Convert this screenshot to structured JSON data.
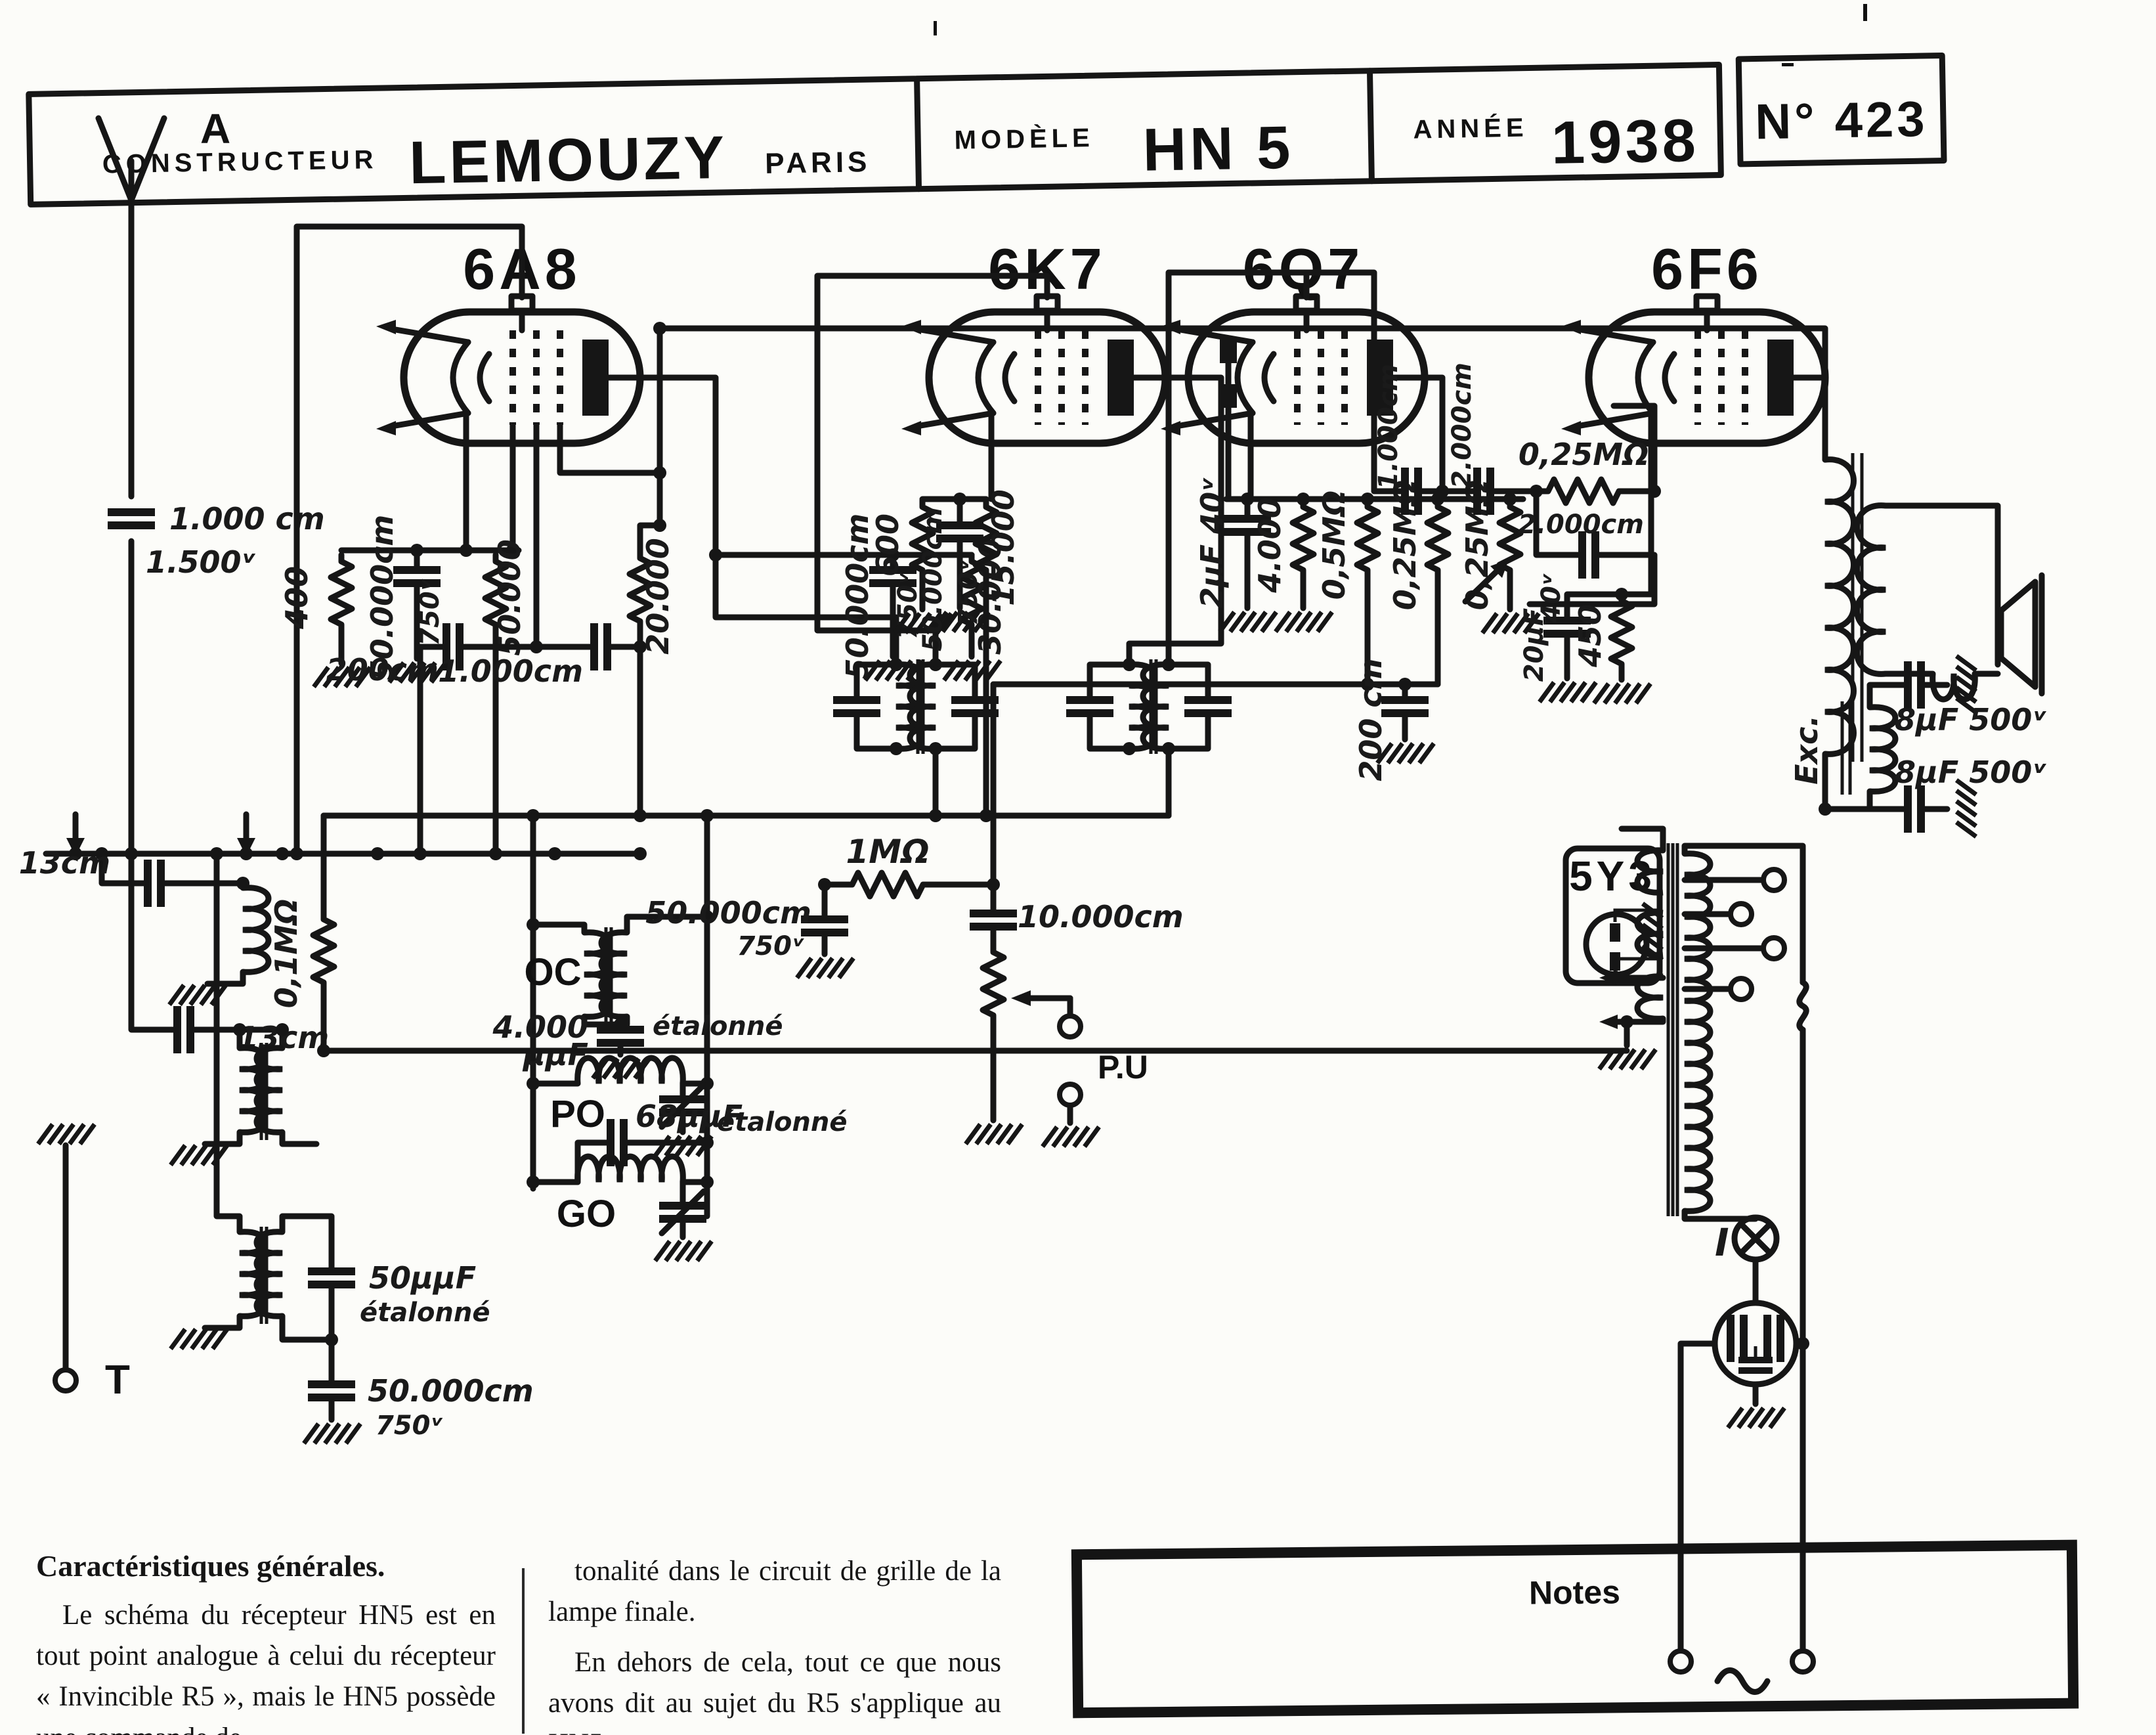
{
  "header": {
    "constructeur_label": "CONSTRUCTEUR",
    "brand": "LEMOUZY",
    "city": "PARIS",
    "modele_label": "MODÈLE",
    "modele_value": "HN 5",
    "annee_label": "ANNÉE",
    "annee_value": "1938",
    "numero": "N° 423"
  },
  "tubes": {
    "t1": "6A8",
    "t2": "6K7",
    "t3": "6Q7",
    "t4": "6F6",
    "rectifier": "5Y3"
  },
  "terminals": {
    "antenna": "A",
    "earth": "T",
    "pickup": "P.U",
    "pilot_lamp": "I",
    "field_coil": "Exc."
  },
  "values": {
    "ant_cap": "1.000 cm",
    "ant_cap_v": "1.500ᵛ",
    "r400": "400",
    "c50k_a": "50.000cm",
    "v750_a": "750ᵛ",
    "r50k": "50.000",
    "c50k_b": "50.000cm",
    "v750_b": "750ᵛ",
    "r30k": "30.000",
    "c200_a": "200cm",
    "c1000_a": "1.000cm",
    "r20k": "20.000",
    "r600": "600",
    "c50k_c": "50.000cm",
    "v750_c": "750ᵛ",
    "r15k": "15.000",
    "c2uf": "2μF 40ᵛ",
    "r4k": "4.000",
    "r05m": "0,5MΩ",
    "c200_b": "200 cm",
    "r025m_a": "0,25MΩ",
    "r025m_b": "0,25MΩ",
    "c1000_b": "1.000cm",
    "c2000_a": "2.000cm",
    "r025m_h": "0,25MΩ",
    "c2000_b": "2.000cm",
    "c20uf": "20μF",
    "v40": "40ᵛ",
    "r450": "450",
    "c8uf_a": "8μF 500ᵛ",
    "c8uf_b": "8μF 500ᵛ",
    "c13_a": "13cm",
    "c13_b": "13cm",
    "r01m": "0,1MΩ",
    "c50pf": "50μμF",
    "et_a": "étalonné",
    "c50k_d": "50.000cm",
    "v750_d": "750ᵛ",
    "band_oc": "OC",
    "band_po": "PO",
    "band_go": "GO",
    "c4000pf": "4.000",
    "uuf": "μμF",
    "et_b": "étalonné",
    "c68pf": "68μμF",
    "et_c": "étalonné",
    "c50k_e": "50.000cm",
    "v750_e": "750ᵛ",
    "r1m": "1MΩ",
    "c10k": "10.000cm"
  },
  "footer": {
    "col1_heading": "Caractéristiques générales.",
    "col1_text": "Le schéma du récepteur HN5 est en tout point analogue à celui du récepteur « Invincible R5 », mais le HN5 possède une commande de",
    "col2_text_1": "tonalité dans le circuit de grille de la lampe finale.",
    "col2_text_2": "En dehors de cela, tout ce que nous avons dit au sujet du R5 s'applique au HN5.",
    "notes_title": "Notes"
  }
}
